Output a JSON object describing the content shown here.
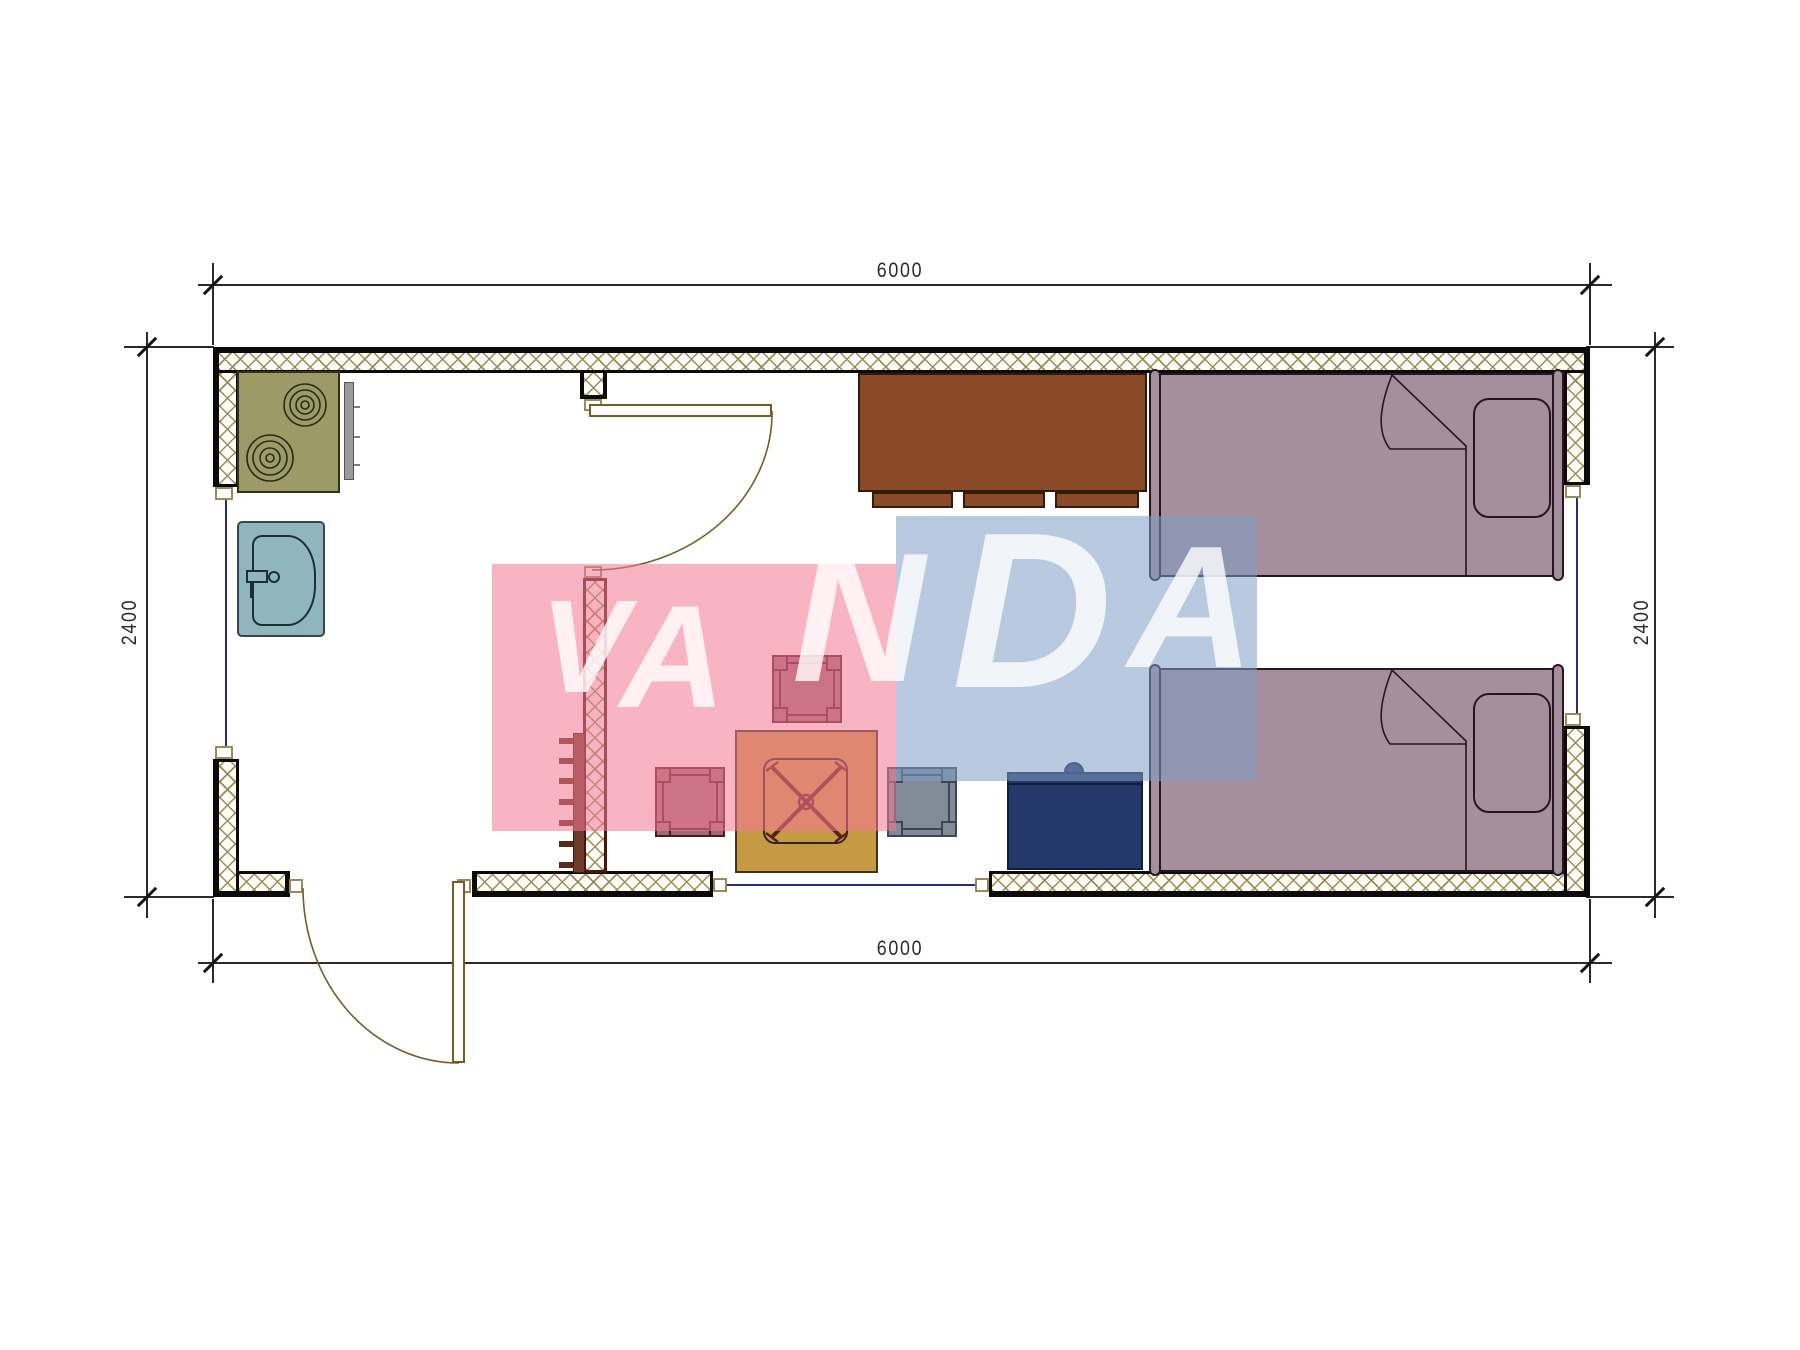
{
  "drawing": {
    "type": "architectural-floor-plan",
    "unit_note": "dimension labels are the only text rendered on the plan"
  },
  "dimensions": {
    "top": "6000",
    "bottom": "6000",
    "left": "2400",
    "right": "2400"
  },
  "watermark": {
    "text": "VANDA",
    "letters": [
      "V",
      "A",
      "N",
      "D",
      "A"
    ]
  },
  "furniture_symbols": [
    "stove",
    "kitchen-sink",
    "interior-door",
    "exterior-door",
    "towel-ladder",
    "cabinet",
    "bed",
    "bed",
    "pillow",
    "pillow",
    "nightstand",
    "coffee-table",
    "stool",
    "stool",
    "stool",
    "window",
    "window",
    "window"
  ],
  "colors": {
    "wall_hatch": "#9b8b58",
    "partition_border": "#4a150e",
    "stove": "#9c9b68",
    "sink": "#8fb5bd",
    "cabinet": "#8a4a28",
    "bed": "#a68f9c",
    "bed_border": "#241722",
    "table": "#c69a42",
    "table_leg": "#5c1f16",
    "stool_mauve": "#9b6b76",
    "stool_mauve_frame": "#4d1a1c",
    "stool_gray": "#828c99",
    "stool_gray_frame": "#3e4656",
    "nightstand": "#25386b",
    "ladder": "#6e3b28",
    "door_line": "#7a5a24",
    "window_line": "#2a2a7a",
    "dim_color": "#2a2a2a",
    "wm_pink": "rgba(242,122,148,0.56)",
    "wm_blue": "rgba(128,157,199,0.55)",
    "wm_text": "rgba(255,255,255,0.8)"
  }
}
